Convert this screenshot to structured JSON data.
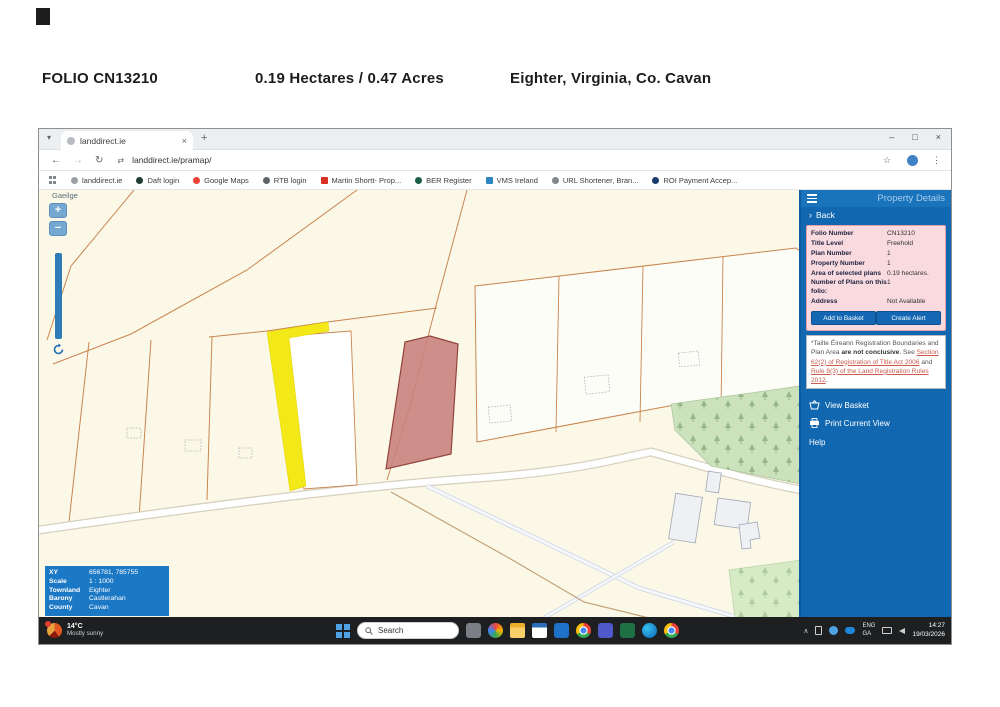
{
  "scan_header": {
    "folio": "FOLIO CN13210",
    "area": "0.19 Hectares  /  0.47 Acres",
    "location": "Eighter, Virginia, Co. Cavan"
  },
  "browser": {
    "tab_title": "landdirect.ie",
    "url": "landdirect.ie/pramap/",
    "glyphs": {
      "tab_list": "▾",
      "plus": "+",
      "minimize": "–",
      "restore": "□",
      "close": "×",
      "close_small": "×",
      "back": "←",
      "forward": "→",
      "reload": "↻",
      "site_info": "⇄",
      "star": "☆",
      "kebab": "⋮",
      "back_chevron": "›",
      "chevron_up": "∧"
    },
    "bookmarks": [
      {
        "label": "landdirect.ie"
      },
      {
        "label": "Daft login"
      },
      {
        "label": "Google Maps"
      },
      {
        "label": "RTB login"
      },
      {
        "label": "Martin Shortt- Prop..."
      },
      {
        "label": "BER Register"
      },
      {
        "label": "VMS Ireland"
      },
      {
        "label": "URL Shortener, Bran..."
      },
      {
        "label": "ROI Payment Accep..."
      }
    ]
  },
  "map": {
    "language_label": "Gaeilge",
    "zoom_in_label": "+",
    "zoom_out_label": "−",
    "info_rows": [
      {
        "label": "XY",
        "value": "656781, 785755"
      },
      {
        "label": "Scale",
        "value": "1 : 1000"
      },
      {
        "label": "Townland",
        "value": "Eighter"
      },
      {
        "label": "Barony",
        "value": "Castlerahan"
      },
      {
        "label": "County",
        "value": "Cavan"
      }
    ],
    "colors": {
      "background": "#FBF8E8",
      "boundary_orange": "#C9854F",
      "highlight_yellow": "#F4E918",
      "selected_parcel_red": "#C9827E",
      "forest_green": "#CBE2BC",
      "panel_blue": "#1168B1"
    }
  },
  "panel": {
    "title": "Property Details",
    "back_label": "Back",
    "details_rows": [
      {
        "label": "Folio Number",
        "value": "CN13210"
      },
      {
        "label": "Title Level",
        "value": "Freehold"
      },
      {
        "label": "Plan Number",
        "value": "1"
      },
      {
        "label": "Property Number",
        "value": "1"
      },
      {
        "label": "Area of selected plans",
        "value": "0.19 hectares."
      },
      {
        "label": "Number of Plans on this folio:",
        "value": "1"
      },
      {
        "label": "Address",
        "value": "Not Available"
      }
    ],
    "buttons": {
      "add_to_basket": "Add to Basket",
      "create_alert": "Create Alert"
    },
    "disclaimer": {
      "p1": "*Tailte Éireann Registration Boundaries and Plan Area ",
      "bold": "are not conclusive",
      "p2": ". See ",
      "link1": "Section 62(2) of Registration of Title Act 2006",
      "p3": " and ",
      "link2": "Rule 8(3) of the Land Registration Rules 2012",
      "p4": "."
    },
    "menu": [
      {
        "label": "View Basket"
      },
      {
        "label": "Print Current View"
      },
      {
        "label": "Help"
      }
    ]
  },
  "taskbar": {
    "weather_temp": "14°C",
    "weather_condition": "Mostly sunny",
    "search_placeholder": "Search",
    "lang_line1": "ENG",
    "lang_line2": "GA",
    "time": "14:27",
    "date": "19/03/2026",
    "app_icons": [
      "task-view",
      "photos",
      "file-explorer",
      "calendar",
      "outlook",
      "chrome",
      "teams",
      "excel",
      "edge",
      "chrome"
    ]
  }
}
